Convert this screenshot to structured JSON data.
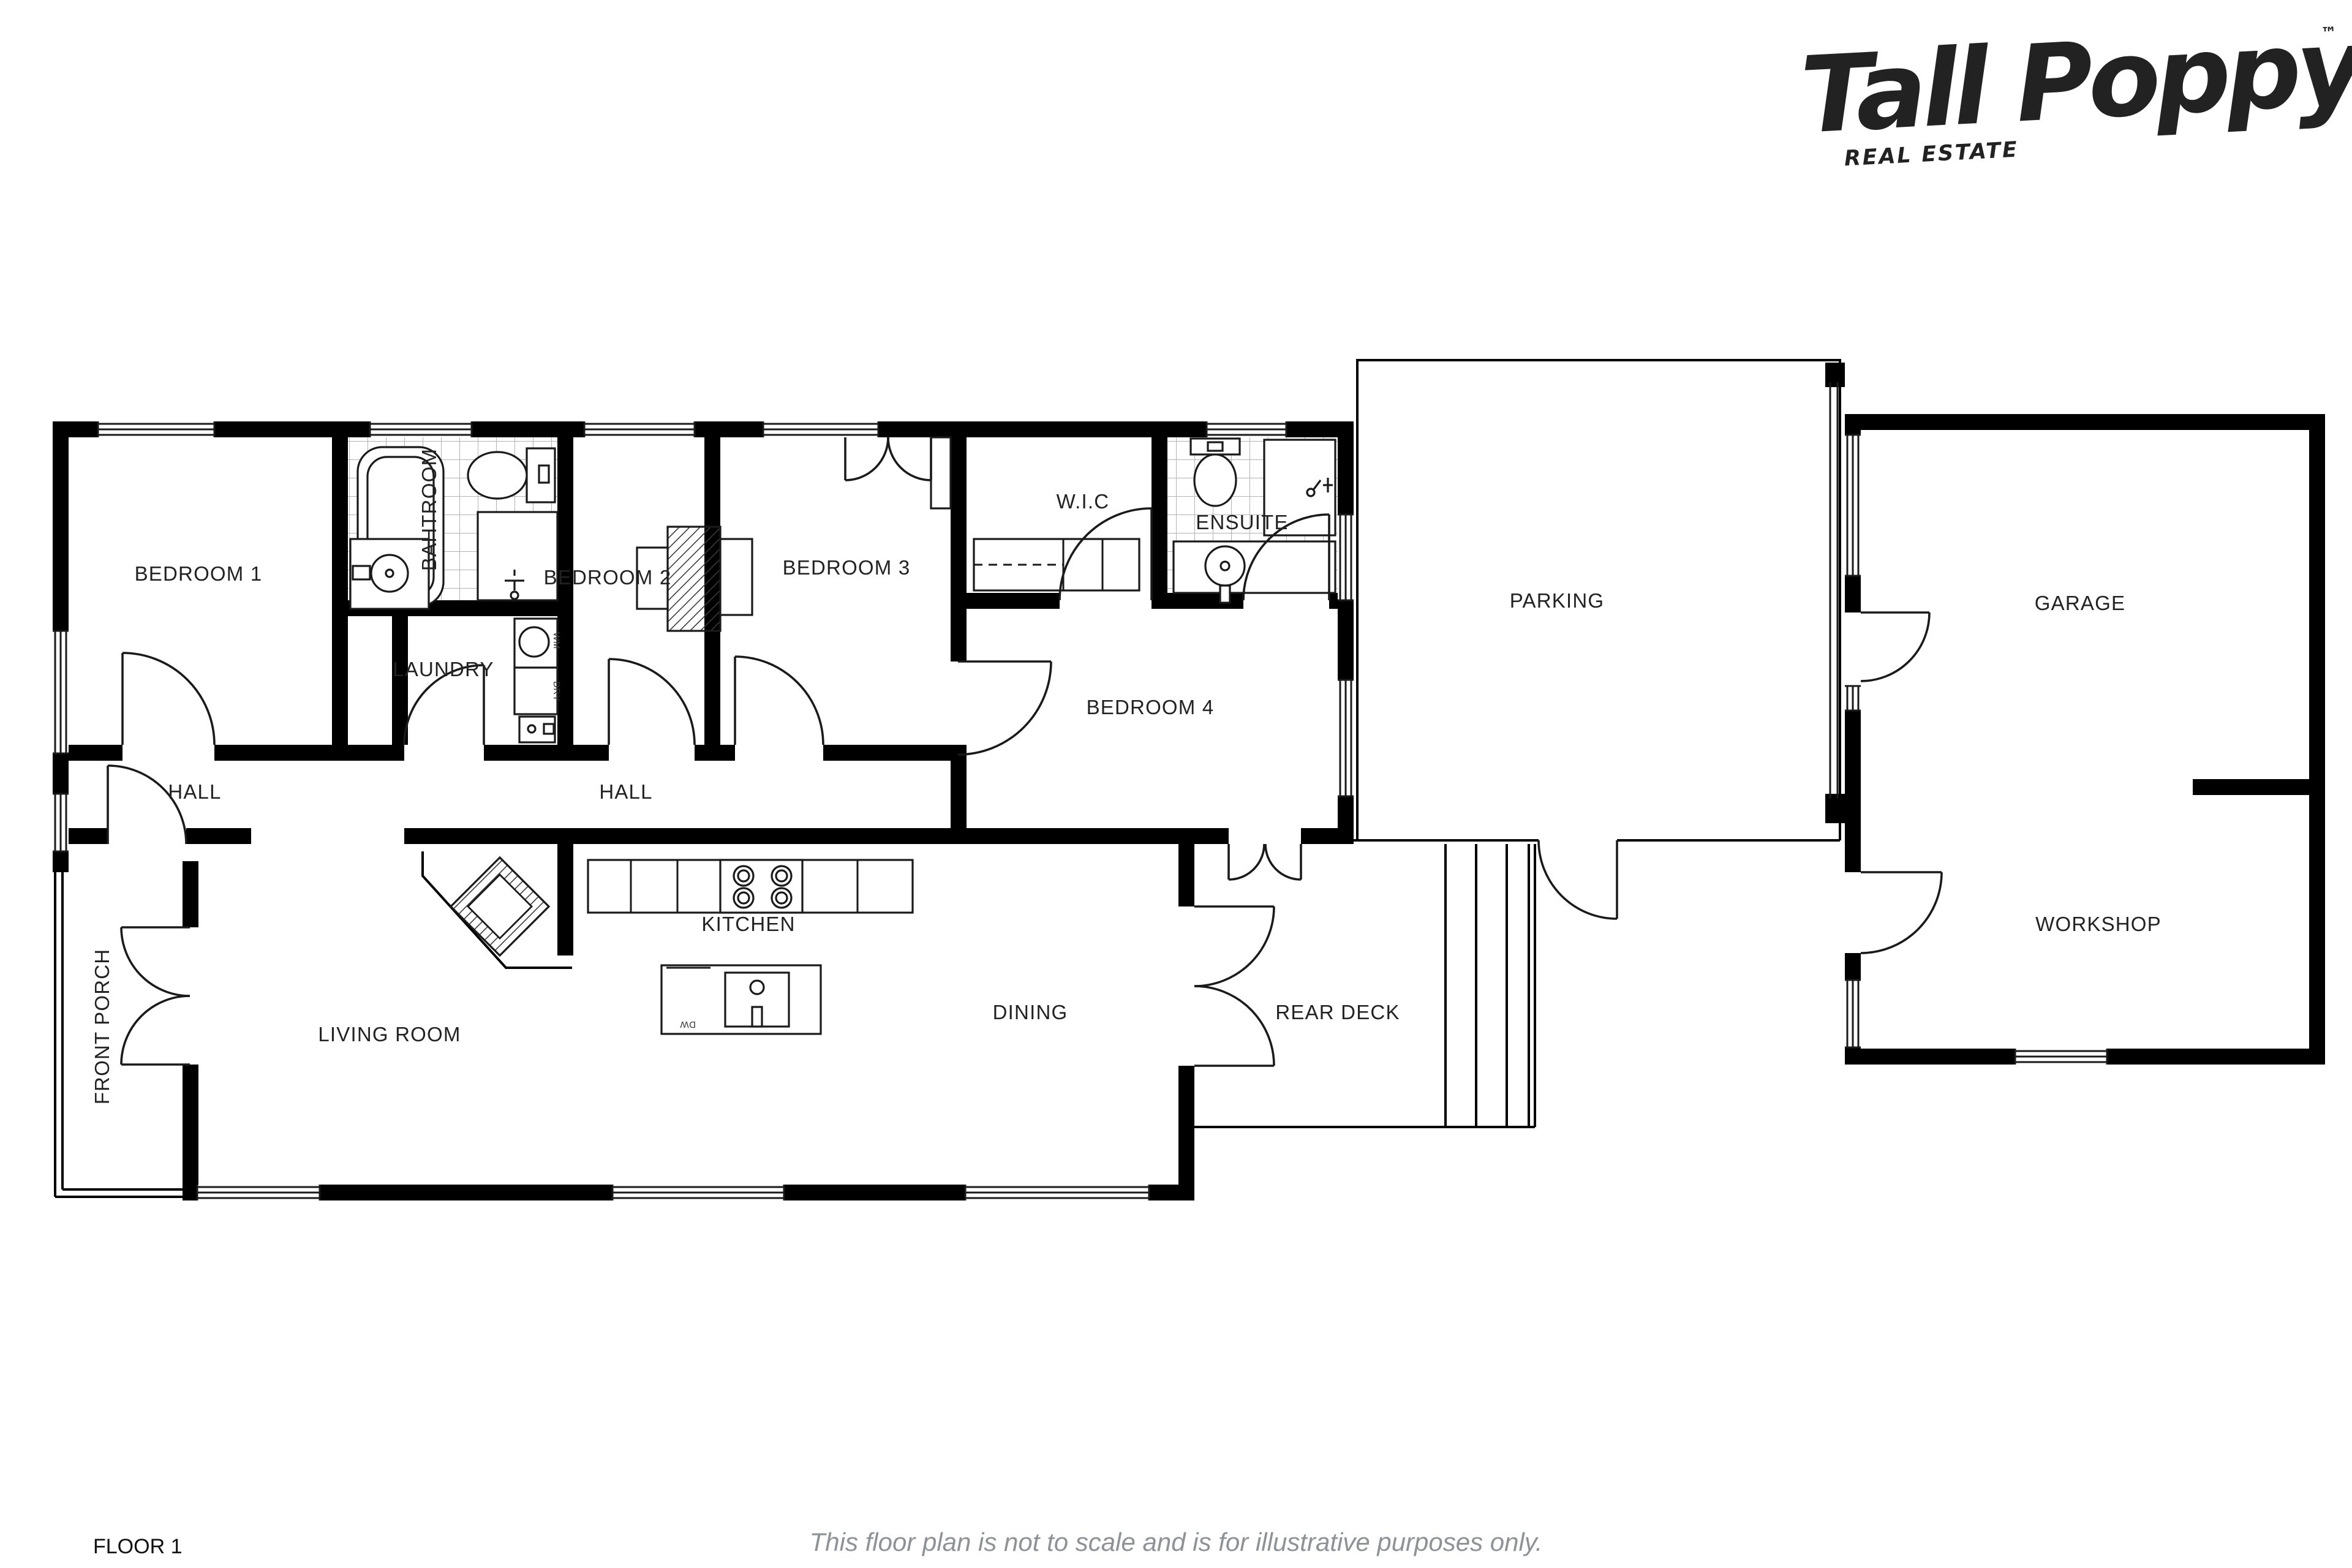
{
  "brand": {
    "name": "Tall Poppy",
    "tagline": "REAL ESTATE",
    "trademark": "™",
    "color": "#e4232e"
  },
  "footer": {
    "floor_label": "FLOOR 1",
    "disclaimer": "This floor plan is not to scale and is for illustrative purposes only."
  },
  "rooms": [
    {
      "id": "bedroom1",
      "label": "BEDROOM 1"
    },
    {
      "id": "bathroom",
      "label": "BAHTROOM"
    },
    {
      "id": "laundry",
      "label": "LAUNDRY"
    },
    {
      "id": "bedroom2",
      "label": "BEDROOM 2"
    },
    {
      "id": "bedroom3",
      "label": "BEDROOM 3"
    },
    {
      "id": "wic",
      "label": "W.I.C"
    },
    {
      "id": "ensuite",
      "label": "ENSUITE"
    },
    {
      "id": "bedroom4",
      "label": "BEDROOM 4"
    },
    {
      "id": "hall-left",
      "label": "HALL"
    },
    {
      "id": "hall-right",
      "label": "HALL"
    },
    {
      "id": "front-porch",
      "label": "FRONT PORCH"
    },
    {
      "id": "living-room",
      "label": "LIVING ROOM"
    },
    {
      "id": "kitchen",
      "label": "KITCHEN"
    },
    {
      "id": "dining",
      "label": "DINING"
    },
    {
      "id": "rear-deck",
      "label": "REAR DECK"
    },
    {
      "id": "parking",
      "label": "PARKING"
    },
    {
      "id": "garage",
      "label": "GARAGE"
    },
    {
      "id": "workshop",
      "label": "WORKSHOP"
    }
  ],
  "appliances": {
    "washing_machine": "WM",
    "dryer": "DRY",
    "dishwasher": "DW"
  }
}
